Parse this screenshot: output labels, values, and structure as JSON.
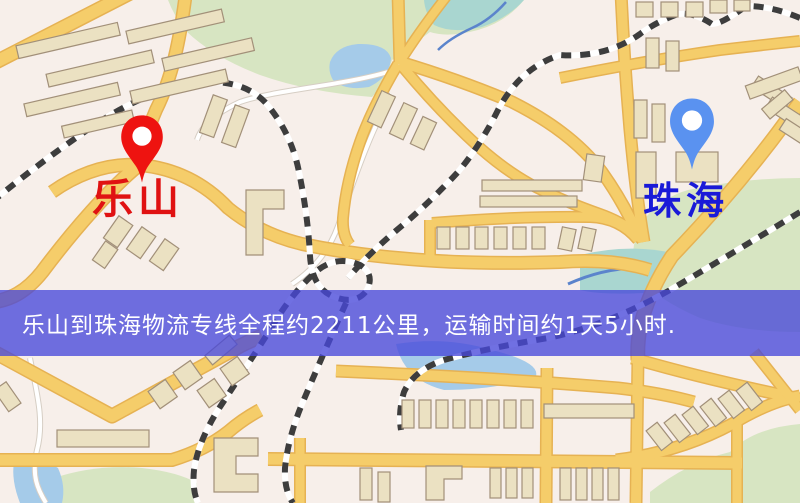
{
  "banner": {
    "text": "乐山到珠海物流专线全程约2211公里，运输时间约1天5小时."
  },
  "markers": {
    "origin": {
      "label": "乐山"
    },
    "destination": {
      "label": "珠海"
    }
  },
  "colors": {
    "land": "#f7efea",
    "park": "#d7e5c2",
    "water": "#a5cbe9",
    "water_teal": "#a9d6d0",
    "road": "#f5cd6a",
    "road_casing": "#e6b253",
    "minor_road": "#ffffff",
    "minor_road_casing": "#d6cec4",
    "railway_dark": "#3d3d3d",
    "railway_light": "#ffffff",
    "building_fill": "#ebe1c2",
    "building_stroke": "#a29079",
    "banner_bg": "rgba(72,72,218,0.78)",
    "banner_text": "#ffffff",
    "origin_pin": "#ee1310",
    "origin_label": "#e01212",
    "destination_pin": "#5a92f0",
    "destination_label": "#1a1ad8",
    "stream_line": "#5b84cc"
  }
}
